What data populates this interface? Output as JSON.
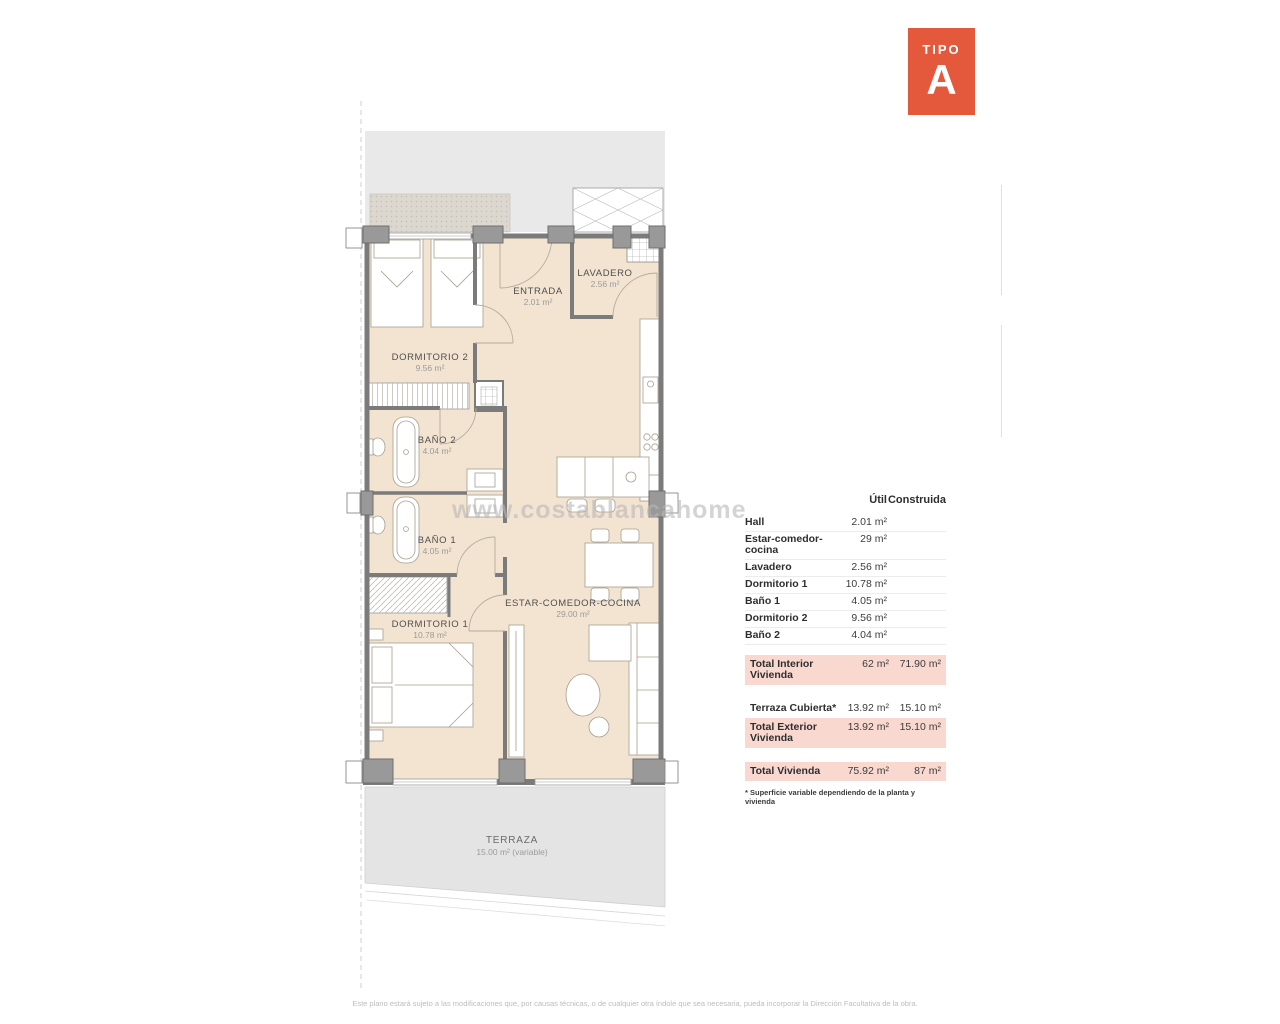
{
  "badge": {
    "label": "TIPO",
    "letter": "A",
    "color": "#e4593b"
  },
  "plan": {
    "watermark": "www.costablancahome",
    "rooms": [
      {
        "name": "DORMITORIO 2",
        "area": "9.56 m²"
      },
      {
        "name": "ENTRADA",
        "area": "2.01 m²"
      },
      {
        "name": "LAVADERO",
        "area": "2.56 m²"
      },
      {
        "name": "BAÑO 2",
        "area": "4.04 m²"
      },
      {
        "name": "BAÑO 1",
        "area": "4.05 m²"
      },
      {
        "name": "DORMITORIO 1",
        "area": "10.78 m²"
      },
      {
        "name": "ESTAR-COMEDOR-COCINA",
        "area": "29.00 m²"
      },
      {
        "name": "TERRAZA",
        "area": "15.00 m² (variable)"
      }
    ],
    "colors": {
      "floor": "#f2e4d1",
      "wall": "#7b7b7b",
      "terrace": "#e4e4e4",
      "common": "#e9e9e9"
    }
  },
  "table": {
    "headers": {
      "util": "Útil",
      "construida": "Construida"
    },
    "rows": [
      {
        "label": "Hall",
        "util": "2.01 m²",
        "construida": ""
      },
      {
        "label": "Estar-comedor-cocina",
        "util": "29 m²",
        "construida": ""
      },
      {
        "label": "Lavadero",
        "util": "2.56 m²",
        "construida": ""
      },
      {
        "label": "Dormitorio 1",
        "util": "10.78 m²",
        "construida": ""
      },
      {
        "label": "Baño 1",
        "util": "4.05 m²",
        "construida": ""
      },
      {
        "label": "Dormitorio 2",
        "util": "9.56 m²",
        "construida": ""
      },
      {
        "label": "Baño 2",
        "util": "4.04 m²",
        "construida": ""
      }
    ],
    "totals": [
      {
        "label": "Total Interior Vivienda",
        "util": "62 m²",
        "construida": "71.90 m²"
      },
      {
        "label": "Terraza Cubierta*",
        "util": "13.92 m²",
        "construida": "15.10 m²"
      },
      {
        "label": "Total Exterior Vivienda",
        "util": "13.92 m²",
        "construida": "15.10 m²"
      },
      {
        "label": "Total Vivienda",
        "util": "75.92 m²",
        "construida": "87 m²"
      }
    ],
    "note": "* Superficie variable dependiendo de la planta y vivienda",
    "highlight_color": "#f9d8d0"
  },
  "footer": {
    "disclaimer": "Este plano estará sujeto a las modificaciones que, por causas técnicas, o de cualquier otra índole que sea necesaria, pueda incorporar la Dirección Facultativa de la obra."
  }
}
